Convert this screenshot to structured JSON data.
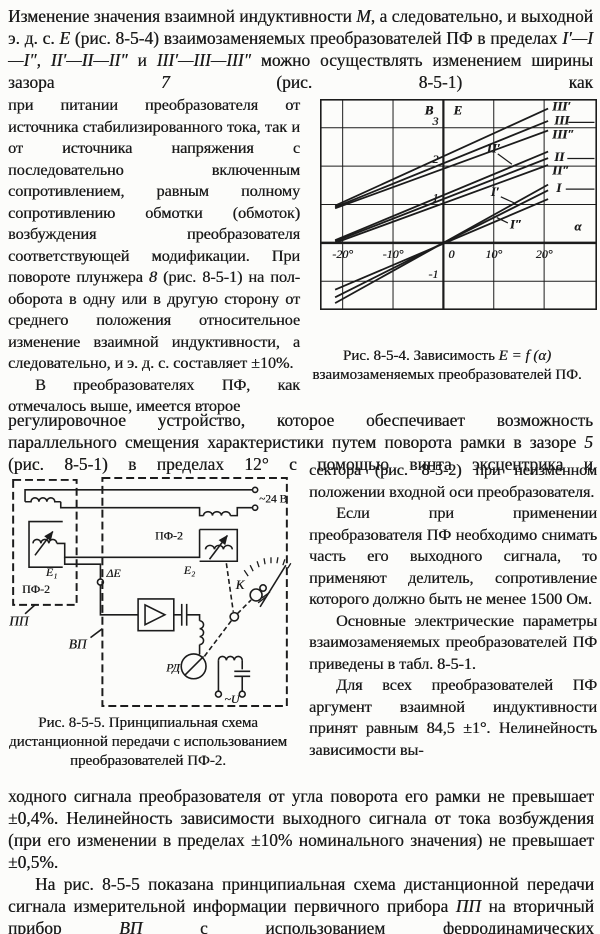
{
  "page": {
    "background": "#fcfcfa",
    "ink": "#1c1c1c"
  },
  "intro": {
    "runs": [
      {
        "t": "Изменение значения взаимной индуктивности "
      },
      {
        "t": "М",
        "i": 1
      },
      {
        "t": ", а следовательно, и выходной э. д. с. "
      },
      {
        "t": "Е",
        "i": 1
      },
      {
        "t": " (рис. 8-5-4) взаимозаменяемых преобразователей ПФ в пределах "
      },
      {
        "t": "I′—I—I″, II′—II—II″",
        "i": 1
      },
      {
        "t": " и "
      },
      {
        "t": "III′—III—III″",
        "i": 1
      },
      {
        "t": " можно осуществлять изменением ширины зазора "
      },
      {
        "t": "7",
        "i": 1
      },
      {
        "t": " (рис. 8-5-1) как"
      }
    ]
  },
  "left_column": {
    "p1": [
      {
        "t": "при питании преобразователя от источника стабилизированного тока, так и от источника напряжения с последовательно включенным сопротивлением, равным полному сопротивлению обмотки (обмоток) возбуждения преобразователя соответствующей модификации. При повороте плунжера "
      },
      {
        "t": "8",
        "i": 1
      },
      {
        "t": " (рис. 8-5-1) на пол-оборота в одну или в другую сторону от среднего положения относительное изменение взаимной индуктивности, а следовательно, и э. д. с. составляет ±10%."
      }
    ],
    "p2": [
      {
        "t": "В преобразователях ПФ, как отмечалось выше, имеется второе"
      }
    ]
  },
  "mid": {
    "runs": [
      {
        "t": "регулировочное устройство, которое обеспечивает возможность параллельного смещения характеристики путем поворота рамки в зазоре "
      },
      {
        "t": "5",
        "i": 1
      },
      {
        "t": " (рис. 8-5-1) в пределах 12° с помощью винта эксцентрика и"
      }
    ]
  },
  "right_column": {
    "p1": [
      {
        "t": "сектора (рис. 8-5-2) при неизменном положении входной оси преобразователя."
      }
    ],
    "p2": [
      {
        "t": "Если при применении преобразователя ПФ необходимо снимать часть его выходного сигнала, то применяют делитель, сопротивление которого должно быть не менее 1500 Ом."
      }
    ],
    "p3": [
      {
        "t": "Основные электрические параметры взаимозаменяемых преобразователей ПФ приведены в табл. 8-5-1."
      }
    ],
    "p4": [
      {
        "t": "Для всех преобразователей ПФ аргумент взаимной индуктивности принят равным 84,5 ±1°. Нелинейность зависимости вы-"
      }
    ]
  },
  "bottom": {
    "p1": [
      {
        "t": "ходного сигнала преобразователя от угла поворота его рамки не превышает ±0,4%. Нелинейность зависимости выходного сигнала от тока возбуждения (при его изменении в пределах ±10% номинального значения) не превышает ±0,5%."
      }
    ],
    "p2": [
      {
        "t": "На рис. 8-5-5 показана принципиальная схема дистанционной передачи сигнала измерительной информации первичного прибора "
      },
      {
        "t": "ПП",
        "i": 1
      },
      {
        "t": " на вторичный прибор "
      },
      {
        "t": "ВП",
        "i": 1
      },
      {
        "t": " с использованием ферродинамических"
      }
    ]
  },
  "figure1": {
    "caption_runs": [
      {
        "t": "Рис. 8-5-4. Зависимость "
      },
      {
        "t": "Е = f (α)",
        "i": 1
      },
      {
        "t": " взаимозаменяемых преобразователей ПФ."
      }
    ]
  },
  "figure2": {
    "caption_runs": [
      {
        "t": "Рис. 8-5-5. Принципиальная схема дистанционной передачи с использованием преобразователей ПФ-2."
      }
    ]
  },
  "chart_data": {
    "type": "line",
    "figure": "Рис. 8-5-4",
    "xlabel": "α",
    "ylabel": "E",
    "ylabel_units": "В",
    "xlim": [
      -24.5,
      30.5
    ],
    "ylim": [
      -1.75,
      3.75
    ],
    "grid": true,
    "x_ticks": [
      {
        "v": -20,
        "label": "-20°"
      },
      {
        "v": -10,
        "label": "-10°"
      },
      {
        "v": 0,
        "label": "0"
      },
      {
        "v": 10,
        "label": "10°"
      },
      {
        "v": 20,
        "label": "20°"
      }
    ],
    "y_ticks": [
      {
        "v": 3,
        "label": "3"
      },
      {
        "v": 2,
        "label": "2"
      },
      {
        "v": 1,
        "label": "1"
      },
      {
        "v": -1,
        "label": "-1"
      }
    ],
    "series": [
      {
        "name": "III′",
        "pts": [
          [
            -21.5,
            0.97
          ],
          [
            20.8,
            3.5
          ]
        ]
      },
      {
        "name": "III",
        "pts": [
          [
            -21.5,
            0.93
          ],
          [
            20.8,
            3.18
          ]
        ]
      },
      {
        "name": "III″",
        "pts": [
          [
            -21.5,
            0.9
          ],
          [
            20.8,
            2.93
          ]
        ]
      },
      {
        "name": "II′",
        "pts": [
          [
            -21.5,
            0.07
          ],
          [
            20.8,
            2.38
          ]
        ]
      },
      {
        "name": "II",
        "pts": [
          [
            -21.5,
            0.04
          ],
          [
            20.8,
            2.21
          ]
        ]
      },
      {
        "name": "II″",
        "pts": [
          [
            -21.5,
            0.0
          ],
          [
            20.8,
            2.03
          ]
        ]
      },
      {
        "name": "I′",
        "pts": [
          [
            -21.5,
            -1.57
          ],
          [
            20.8,
            1.52
          ]
        ]
      },
      {
        "name": "I",
        "pts": [
          [
            -21.5,
            -1.42
          ],
          [
            20.8,
            1.37
          ]
        ]
      },
      {
        "name": "I″",
        "pts": [
          [
            -21.5,
            -1.22
          ],
          [
            20.8,
            1.14
          ]
        ]
      }
    ],
    "axis_labels": [
      {
        "text": "В",
        "x": -2.0,
        "y": 3.35,
        "anchor": "end"
      },
      {
        "text": "E",
        "x": 2.0,
        "y": 3.35,
        "anchor": "start"
      },
      {
        "text": "α",
        "x": 26.0,
        "y": 0.32,
        "anchor": "start"
      }
    ],
    "curve_labels": [
      {
        "text": "III′",
        "x": 21.6,
        "y": 3.45,
        "anchor": "start"
      },
      {
        "text": "III",
        "x": 22.0,
        "y": 3.08,
        "anchor": "start"
      },
      {
        "text": "III″",
        "x": 21.6,
        "y": 2.72,
        "anchor": "start"
      },
      {
        "text": "II′",
        "x": 8.6,
        "y": 2.35,
        "anchor": "start"
      },
      {
        "text": "II",
        "x": 22.0,
        "y": 2.14,
        "anchor": "start"
      },
      {
        "text": "II″",
        "x": 21.6,
        "y": 1.78,
        "anchor": "start"
      },
      {
        "text": "I′",
        "x": 9.4,
        "y": 1.22,
        "anchor": "start"
      },
      {
        "text": "I",
        "x": 22.4,
        "y": 1.32,
        "anchor": "start"
      },
      {
        "text": "I″",
        "x": 13.2,
        "y": 0.38,
        "anchor": "start"
      }
    ],
    "leaders": [
      [
        [
          24.8,
          3.14
        ],
        [
          30.0,
          3.14
        ]
      ],
      [
        [
          24.6,
          2.2
        ],
        [
          30.0,
          2.2
        ]
      ],
      [
        [
          24.3,
          1.4
        ],
        [
          30.0,
          1.4
        ]
      ],
      [
        [
          10.8,
          2.32
        ],
        [
          13.6,
          2.05
        ]
      ],
      [
        [
          11.4,
          1.2
        ],
        [
          14.4,
          1.02
        ]
      ],
      [
        [
          12.8,
          0.52
        ],
        [
          10.6,
          0.66
        ]
      ]
    ]
  },
  "schematic": {
    "labels": {
      "pp": "ПП",
      "vp": "ВП",
      "pf2_left": "ПФ-2",
      "pf2_right": "ПФ-2",
      "e1": "Е₁",
      "e2": "Е₂",
      "delta_e": "ΔЕ",
      "k": "К",
      "rd": "РД",
      "v24": "~24 В",
      "u": "~U"
    }
  }
}
